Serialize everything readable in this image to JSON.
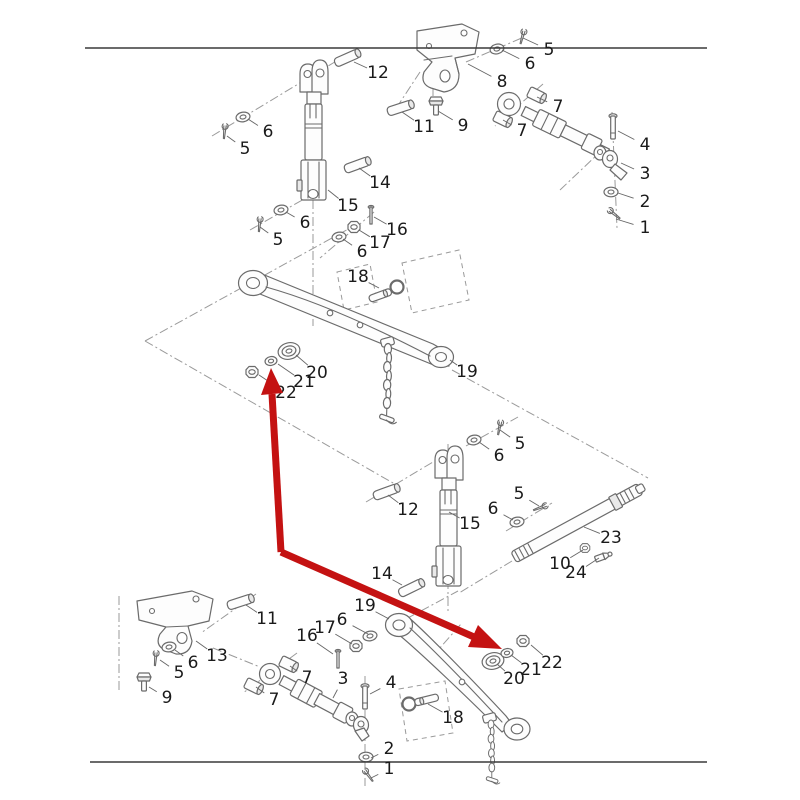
{
  "diagram": {
    "kind": "exploded-parts-diagram",
    "numbers_shown": [
      "1",
      "2",
      "3",
      "4",
      "5",
      "6",
      "7",
      "8",
      "9",
      "10",
      "11",
      "12",
      "13",
      "14",
      "15",
      "16",
      "17",
      "18",
      "19",
      "20",
      "21",
      "22",
      "23",
      "24"
    ],
    "label_font_px": 17,
    "colors": {
      "background": "#ffffff",
      "part_line": "#6b6b6b",
      "construction_line": "#9a9a9a",
      "label_text": "#1a1a1a",
      "frame_line": "#3a3a3a",
      "arrow_red": "#c41212"
    },
    "frame_lines": [
      {
        "x1": 85,
        "y1": 48,
        "x2": 707,
        "y2": 48
      },
      {
        "x1": 90,
        "y1": 762,
        "x2": 707,
        "y2": 762
      }
    ],
    "red_arrow": {
      "color": "#c41212",
      "width": 7,
      "shafts": [
        [
          272,
          394,
          281,
          552
        ],
        [
          281,
          552,
          474,
          637
        ]
      ],
      "heads": [
        [
          [
            271,
            368
          ],
          [
            283,
            393
          ],
          [
            261,
            395
          ]
        ],
        [
          [
            502,
            649
          ],
          [
            468,
            647
          ],
          [
            478,
            625
          ]
        ]
      ]
    },
    "callouts": [
      {
        "n": "12",
        "x": 378,
        "y": 73,
        "tx": 354,
        "ty": 62
      },
      {
        "n": "8",
        "x": 502,
        "y": 82,
        "tx": 468,
        "ty": 64
      },
      {
        "n": "5",
        "x": 549,
        "y": 50,
        "tx": 523,
        "ty": 38
      },
      {
        "n": "6",
        "x": 530,
        "y": 64,
        "tx": 502,
        "ty": 50
      },
      {
        "n": "11",
        "x": 424,
        "y": 127,
        "tx": 402,
        "ty": 112
      },
      {
        "n": "9",
        "x": 463,
        "y": 126,
        "tx": 438,
        "ty": 111
      },
      {
        "n": "7",
        "x": 558,
        "y": 107,
        "tx": 537,
        "ty": 97
      },
      {
        "n": "7",
        "x": 522,
        "y": 131,
        "tx": 503,
        "ty": 120
      },
      {
        "n": "4",
        "x": 645,
        "y": 145,
        "tx": 618,
        "ty": 131
      },
      {
        "n": "3",
        "x": 645,
        "y": 174,
        "tx": 621,
        "ty": 163
      },
      {
        "n": "2",
        "x": 645,
        "y": 202,
        "tx": 618,
        "ty": 193
      },
      {
        "n": "1",
        "x": 645,
        "y": 228,
        "tx": 616,
        "ty": 219
      },
      {
        "n": "6",
        "x": 268,
        "y": 132,
        "tx": 248,
        "ty": 119
      },
      {
        "n": "5",
        "x": 245,
        "y": 149,
        "tx": 227,
        "ty": 136
      },
      {
        "n": "14",
        "x": 380,
        "y": 183,
        "tx": 359,
        "ty": 168
      },
      {
        "n": "15",
        "x": 348,
        "y": 206,
        "tx": 328,
        "ty": 190
      },
      {
        "n": "6",
        "x": 305,
        "y": 223,
        "tx": 286,
        "ty": 212
      },
      {
        "n": "5",
        "x": 278,
        "y": 240,
        "tx": 260,
        "ty": 227
      },
      {
        "n": "16",
        "x": 397,
        "y": 230,
        "tx": 374,
        "ty": 217
      },
      {
        "n": "17",
        "x": 380,
        "y": 243,
        "tx": 359,
        "ty": 230
      },
      {
        "n": "6",
        "x": 362,
        "y": 252,
        "tx": 343,
        "ty": 239
      },
      {
        "n": "18",
        "x": 358,
        "y": 277,
        "tx": 379,
        "ty": 288
      },
      {
        "n": "19",
        "x": 467,
        "y": 372,
        "tx": 450,
        "ty": 360
      },
      {
        "n": "20",
        "x": 317,
        "y": 373,
        "tx": 296,
        "ty": 355
      },
      {
        "n": "21",
        "x": 304,
        "y": 382,
        "tx": 278,
        "ty": 364
      },
      {
        "n": "22",
        "x": 286,
        "y": 393,
        "tx": 259,
        "ty": 375
      },
      {
        "n": "5",
        "x": 520,
        "y": 444,
        "tx": 500,
        "ty": 430
      },
      {
        "n": "6",
        "x": 499,
        "y": 456,
        "tx": 479,
        "ty": 442
      },
      {
        "n": "12",
        "x": 408,
        "y": 510,
        "tx": 388,
        "ty": 495
      },
      {
        "n": "15",
        "x": 470,
        "y": 524,
        "tx": 449,
        "ty": 512
      },
      {
        "n": "5",
        "x": 519,
        "y": 494,
        "tx": 539,
        "ty": 506
      },
      {
        "n": "6",
        "x": 493,
        "y": 509,
        "tx": 513,
        "ty": 520
      },
      {
        "n": "23",
        "x": 611,
        "y": 538,
        "tx": 584,
        "ty": 527
      },
      {
        "n": "10",
        "x": 560,
        "y": 564,
        "tx": 583,
        "ty": 550
      },
      {
        "n": "24",
        "x": 576,
        "y": 573,
        "tx": 599,
        "ty": 558
      },
      {
        "n": "14",
        "x": 382,
        "y": 574,
        "tx": 402,
        "ty": 585
      },
      {
        "n": "11",
        "x": 267,
        "y": 619,
        "tx": 246,
        "ty": 605
      },
      {
        "n": "13",
        "x": 217,
        "y": 656,
        "tx": 196,
        "ty": 641
      },
      {
        "n": "6",
        "x": 193,
        "y": 663,
        "tx": 175,
        "ty": 650
      },
      {
        "n": "5",
        "x": 179,
        "y": 673,
        "tx": 160,
        "ty": 660
      },
      {
        "n": "9",
        "x": 167,
        "y": 698,
        "tx": 149,
        "ty": 687
      },
      {
        "n": "16",
        "x": 307,
        "y": 636,
        "tx": 333,
        "ty": 654
      },
      {
        "n": "17",
        "x": 325,
        "y": 628,
        "tx": 352,
        "ty": 644
      },
      {
        "n": "6",
        "x": 342,
        "y": 620,
        "tx": 368,
        "ty": 634
      },
      {
        "n": "19",
        "x": 365,
        "y": 606,
        "tx": 389,
        "ty": 619
      },
      {
        "n": "7",
        "x": 307,
        "y": 678,
        "tx": 290,
        "ty": 666
      },
      {
        "n": "7",
        "x": 274,
        "y": 700,
        "tx": 256,
        "ty": 687
      },
      {
        "n": "3",
        "x": 343,
        "y": 679,
        "tx": 333,
        "ty": 698
      },
      {
        "n": "4",
        "x": 391,
        "y": 683,
        "tx": 370,
        "ty": 694
      },
      {
        "n": "18",
        "x": 453,
        "y": 718,
        "tx": 428,
        "ty": 704
      },
      {
        "n": "2",
        "x": 389,
        "y": 749,
        "tx": 371,
        "ty": 758
      },
      {
        "n": "1",
        "x": 389,
        "y": 769,
        "tx": 371,
        "ty": 778
      },
      {
        "n": "22",
        "x": 552,
        "y": 663,
        "tx": 531,
        "ty": 645
      },
      {
        "n": "21",
        "x": 531,
        "y": 670,
        "tx": 511,
        "ty": 655
      },
      {
        "n": "20",
        "x": 514,
        "y": 679,
        "tx": 497,
        "ty": 664
      }
    ]
  }
}
